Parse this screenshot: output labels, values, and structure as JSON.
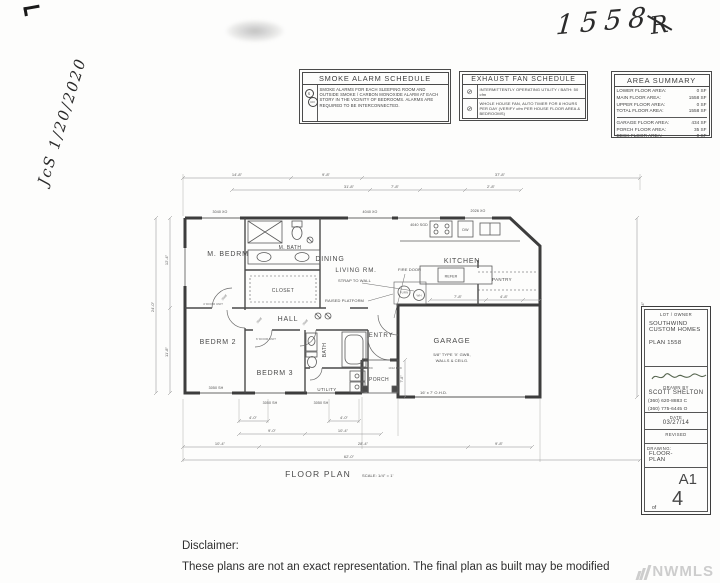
{
  "annotations": {
    "plan_number_hand": "1558",
    "rx_mark": "R",
    "signature_date": "JcS 1/20/2020",
    "watermark": "NWMLS"
  },
  "schedules": {
    "smoke": {
      "title": "SMOKE ALARM SCHEDULE",
      "symbol_s": "S",
      "symbol_co": "CO",
      "body": "SMOKE ALARMS FOR EACH SLEEPING ROOM AND OUTSIDE SMOKE / CARBON MONOXIDE ALARM AT EACH STORY IN THE VICINITY OF BEDROOMS. ALARMS ARE REQUIRED TO BE INTERCONNECTED."
    },
    "exhaust": {
      "title": "EXHAUST FAN SCHEDULE",
      "rows": [
        {
          "symbol": "⊘",
          "text": "INTERMITTENTLY OPERATING UTILITY / BATH: 50 cfm"
        },
        {
          "symbol": "⊘",
          "text": "WHOLE HOUSE FAN, AUTO TIMER FOR 8 HOURS PER DAY (VERIFY cfm PER HOUSE FLOOR AREA & BEDROOMS)"
        }
      ]
    },
    "area_summary": {
      "title": "AREA SUMMARY",
      "rows": [
        {
          "label": "LOWER FLOOR AREA:",
          "value": "0 SF"
        },
        {
          "label": "MAIN FLOOR AREA:",
          "value": "1558 SF"
        },
        {
          "label": "UPPER FLOOR AREA:",
          "value": "0 SF"
        },
        {
          "label": "TOTAL FLOOR AREA:",
          "value": "1558 SF"
        },
        {
          "label": "GARAGE FLOOR AREA:",
          "value": "434 SF"
        },
        {
          "label": "PORCH FLOOR AREA:",
          "value": "35 SF"
        },
        {
          "label": "DECK FLOOR AREA:",
          "value": "0 SF"
        }
      ]
    }
  },
  "plan": {
    "rooms": {
      "m_bedrm": "M. BEDRM",
      "m_bath": "M. BATH",
      "dining": "DINING",
      "kitchen": "KITCHEN",
      "living": "LIVING RM.",
      "hall": "HALL",
      "bedrm2": "BEDRM 2",
      "bedrm3": "BEDRM 3",
      "bath": "BATH",
      "utility": "UTILITY",
      "entry": "ENTRY",
      "garage": "GARAGE",
      "porch": "PORCH",
      "closet": "CLOSET",
      "pantry": "PANTRY"
    },
    "notes": {
      "fire_door": "FIRE DOOR",
      "strap": "STRAP TO WALL",
      "platform": "RAISED PLATFORM",
      "furn": "FURN",
      "wh": "WH",
      "refer": "REFER",
      "dw": "DW",
      "gwb1": "5/8\" TYPE 'X' GWB,",
      "gwb2": "WALLS & CEILG."
    },
    "openings": {
      "w1": "3040 XO",
      "w2": "4040 XO",
      "w3": "4040 SGD",
      "w4": "2026 XO",
      "w5": "3050 SH",
      "w6": "3050 SH",
      "w7": "3050 SH",
      "ohd": "16' x 7' O.H.D.",
      "fx1": "1012 FXD",
      "fx2": "1012 FXD",
      "d1": "4' DOOR UNIT",
      "d2": "6' DOOR UNIT",
      "tag": "2668"
    },
    "dims": {
      "t1": "14'-8\"",
      "t2": "9'-8\"",
      "t3": "37'-8\"",
      "t4": "31'-8\"",
      "t5": "7'-8\"",
      "t6": "2'-8\"",
      "g1": "7'-8\"",
      "g2": "4'-8\"",
      "b1": "4'-0\"",
      "b2": "4'-0\"",
      "b3": "9'-0\"",
      "b4": "10'-4\"",
      "b5": "10'-4\"",
      "b6": "28'-4\"",
      "b7": "9'-8\"",
      "b8": "62'-0\"",
      "l1": "12'-4\"",
      "l2": "11'-8\"",
      "l3": "24'-0\"",
      "r1": "24'-4\"",
      "p1": "7'-8\""
    },
    "caption": "FLOOR PLAN",
    "scale": "SCALE: 1/4\" = 1'"
  },
  "title_block": {
    "lot_owner_label": "LOT / OWNER",
    "company_line1": "SOUTHWIND",
    "company_line2": "CUSTOM HOMES",
    "plan_number": "PLAN 1558",
    "drawn_by_label": "DRAWN BY",
    "drawn_by_name": "SCOTT SHELTON",
    "phone1": "(360) 620-8883 C",
    "phone2": "(360) 775-6445 O",
    "date_label": "DATE",
    "date_value": "03/27/14",
    "revised_label": "REVISED",
    "drawing_label": "DRAWING:",
    "drawing_name1": "FLOOR-",
    "drawing_name2": "PLAN",
    "sheet_number": "A1",
    "sheet_of": "of",
    "sheet_total": "4"
  },
  "footer": {
    "disclaimer_label": "Disclaimer:",
    "disclaimer_text": "These plans are not an exact representation.  The final plan as built may be modified"
  }
}
